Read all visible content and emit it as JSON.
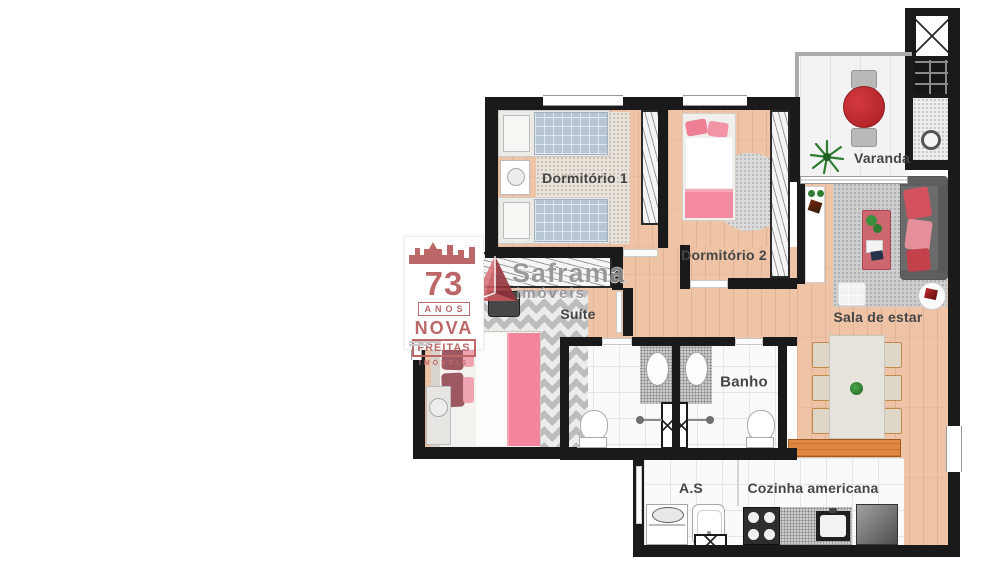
{
  "rooms": {
    "dormitorio1": {
      "label": "Dormitório 1"
    },
    "dormitorio2": {
      "label": "Dormitório 2"
    },
    "varanda": {
      "label": "Varanda"
    },
    "sala": {
      "label": "Sala de estar"
    },
    "suite": {
      "label": "Suíte"
    },
    "banho": {
      "label": "Banho"
    },
    "area_servico": {
      "label": "A.S"
    },
    "cozinha": {
      "label": "Cozinha americana"
    }
  },
  "watermark_left": {
    "years": "73",
    "years_label": "ANOS",
    "brand_line1": "NOVA",
    "brand_line2": "FREITAS",
    "brand_line3": "IMÓVEIS",
    "color": "#bc6868"
  },
  "watermark_center": {
    "brand": "Saframa",
    "sub": "imóveis",
    "triangle_color": "#c9565e",
    "text_color": "#8f8f8f"
  },
  "palette": {
    "wall": "#1a1a1a",
    "wood_floor": "#eec3a6",
    "tile_floor": "#fafafa",
    "accent_red": "#c22a2f",
    "pink_bed": "#f48ca1",
    "sofa_gray": "#6b6b6b",
    "counter_wood": "#e0883f"
  }
}
